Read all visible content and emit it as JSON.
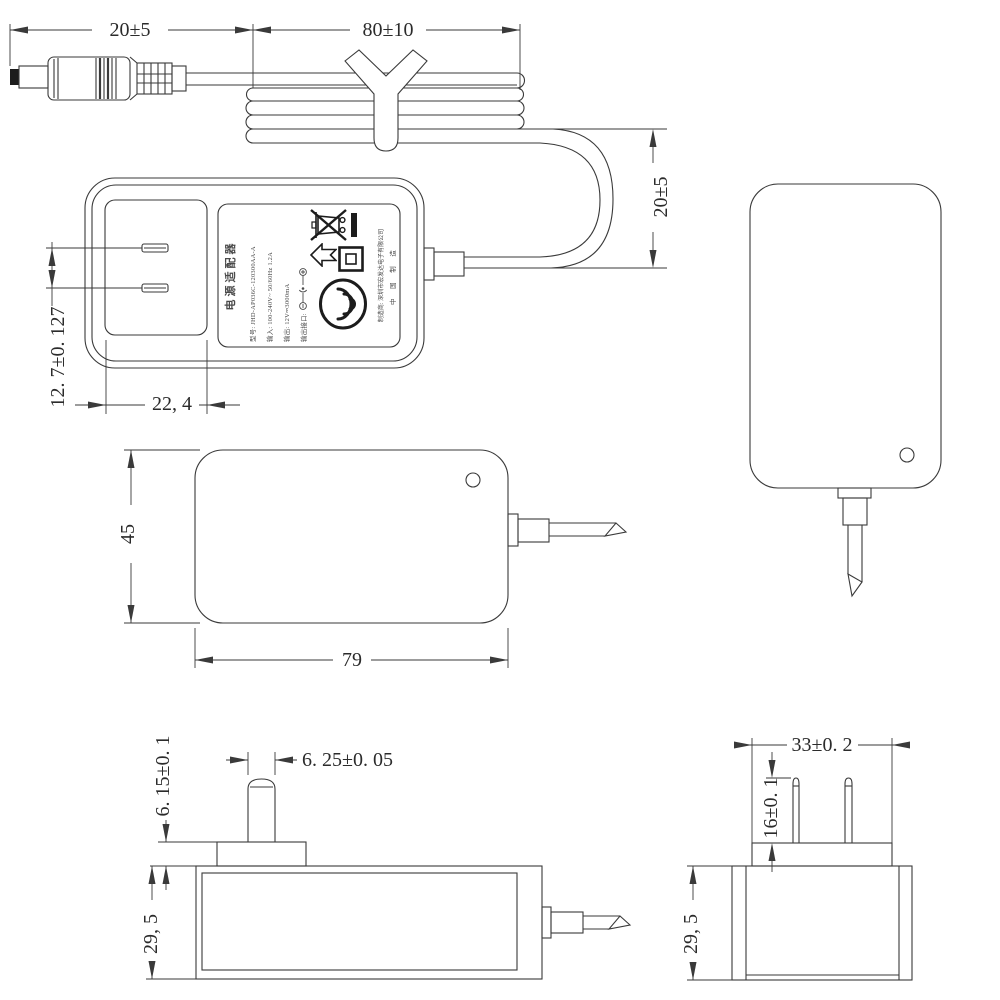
{
  "drawing": {
    "type": "power-adapter-dimension-drawing",
    "colors": {
      "line": "#3a3a3a",
      "background": "#ffffff",
      "label_text": "#4a4a4a"
    }
  },
  "dimensions": {
    "plug_length": "20±5",
    "cable_bundle_length": "80±10",
    "loop_height": "20±5",
    "pin_spacing": "12. 7±0. 127",
    "plug_face_width": "22, 4",
    "body_height": "45",
    "body_width": "79",
    "blade_tip_width": "6. 25±0. 05",
    "pedestal_height": "6. 15±0. 1",
    "body_depth_side": "29, 5",
    "pedestal_width": "33±0. 2",
    "blade_length": "16±0. 1",
    "body_depth_end": "29, 5"
  },
  "label": {
    "product_name": "电源适配器",
    "model": "型号: JHD-AP036C-120300AA-A",
    "input": "输入: 100-240V~ 50/60Hz 1.2A",
    "output": "输出: 12V⎓3000mA",
    "output_port": "输出接口:",
    "manufacturer": "制造商: 深圳市宏发达电子有限公司",
    "made_in": "中 国 制 造",
    "icons": [
      "weee-crossed-bin-icon",
      "weee-black-bar-icon",
      "up-arrow-icon",
      "class-ii-double-square-icon",
      "ccc-certification-icon",
      "dc-polarity-icon"
    ]
  }
}
